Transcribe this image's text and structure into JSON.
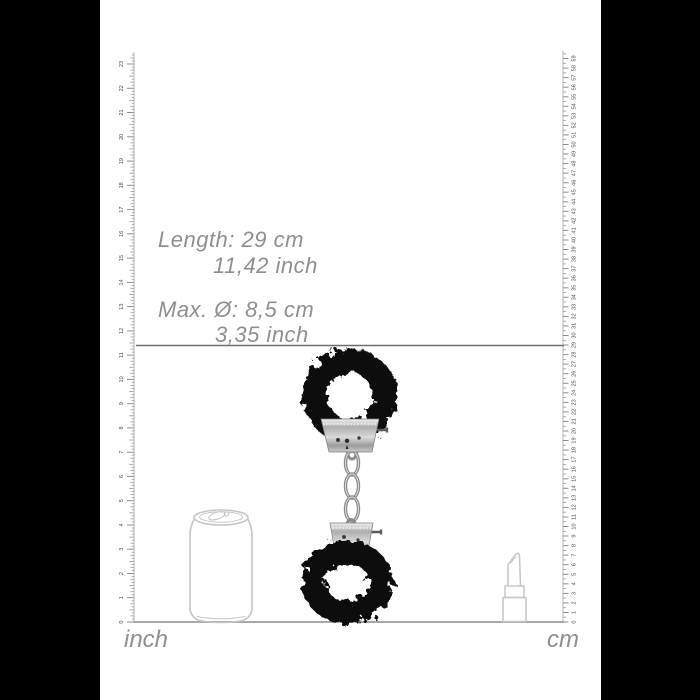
{
  "measurements": {
    "length_line1": "Length: 29 cm",
    "length_line2": "11,42 inch",
    "diameter_line1": "Max. Ø: 8,5 cm",
    "diameter_line2": "3,35 inch"
  },
  "rulers": {
    "inch": {
      "label": "inch",
      "min": 0,
      "max": 23,
      "numbers": [
        0,
        1,
        2,
        3,
        4,
        5,
        6,
        7,
        8,
        9,
        10,
        11,
        12,
        13,
        14,
        15,
        16,
        17,
        18,
        19,
        20,
        21,
        22,
        23
      ]
    },
    "cm": {
      "label": "cm",
      "min": 0,
      "max": 59,
      "numbers": [
        0,
        1,
        2,
        3,
        4,
        5,
        6,
        7,
        8,
        9,
        10,
        11,
        12,
        13,
        14,
        15,
        16,
        17,
        18,
        19,
        20,
        21,
        22,
        23,
        24,
        25,
        26,
        27,
        28,
        29,
        30,
        31,
        32,
        33,
        34,
        35,
        36,
        37,
        38,
        39,
        40,
        41,
        42,
        43,
        44,
        45,
        46,
        47,
        48,
        49,
        50,
        51,
        52,
        53,
        54,
        55,
        56,
        57,
        58,
        59
      ]
    }
  },
  "product": {
    "name": "black furry handcuffs",
    "fur_color": "#0a0a0a",
    "metal_color": "#b9b9b9"
  },
  "scale_objects": [
    {
      "name": "soda can outline"
    },
    {
      "name": "lipstick outline"
    }
  ],
  "colors": {
    "background": "#000000",
    "canvas": "#ffffff",
    "text_gray": "#8f8f8f",
    "ruler_gray": "#9a9a9a",
    "indicator_line": "#6e6e6e",
    "outline_gray": "#c6c6c6"
  }
}
